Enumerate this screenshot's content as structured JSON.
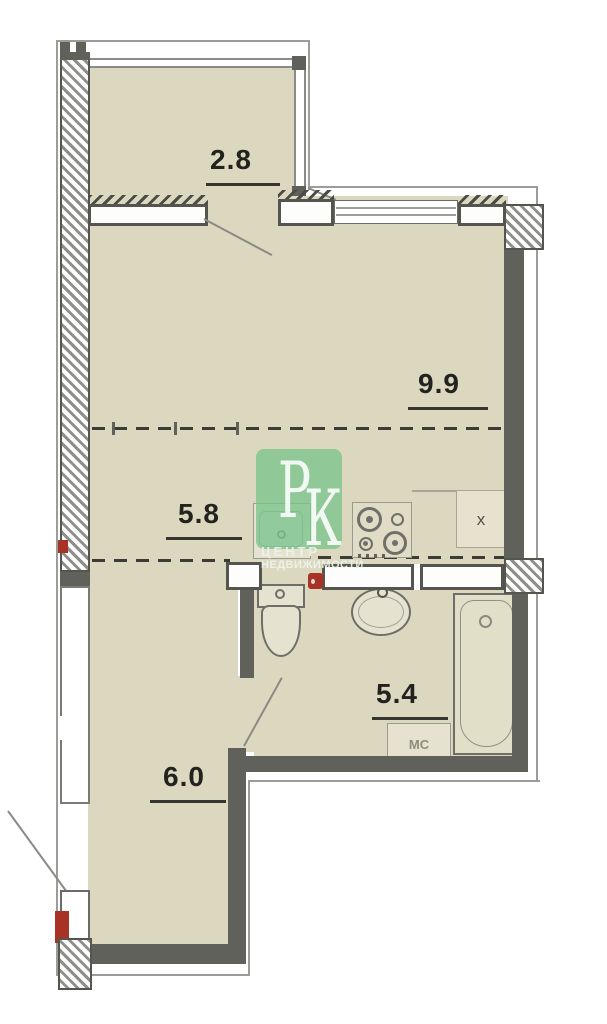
{
  "plan": {
    "rooms": {
      "balcony": {
        "area": "2.8"
      },
      "living": {
        "area": "9.9"
      },
      "kitchen": {
        "area": "5.8"
      },
      "bathroom": {
        "area": "5.4"
      },
      "hallway": {
        "area": "6.0"
      }
    },
    "labels": {
      "washing_machine": "МС",
      "vent": "x"
    },
    "watermark": {
      "logo_p": "Р",
      "logo_k": "К",
      "line1": "ЦЕНТР",
      "line2": "НЕДВИЖИМОСТИ"
    },
    "colors": {
      "floor": "#dcd8bf",
      "wall": "#61615c",
      "accent_red": "#a93226",
      "watermark_green": "#7bc48c"
    }
  }
}
